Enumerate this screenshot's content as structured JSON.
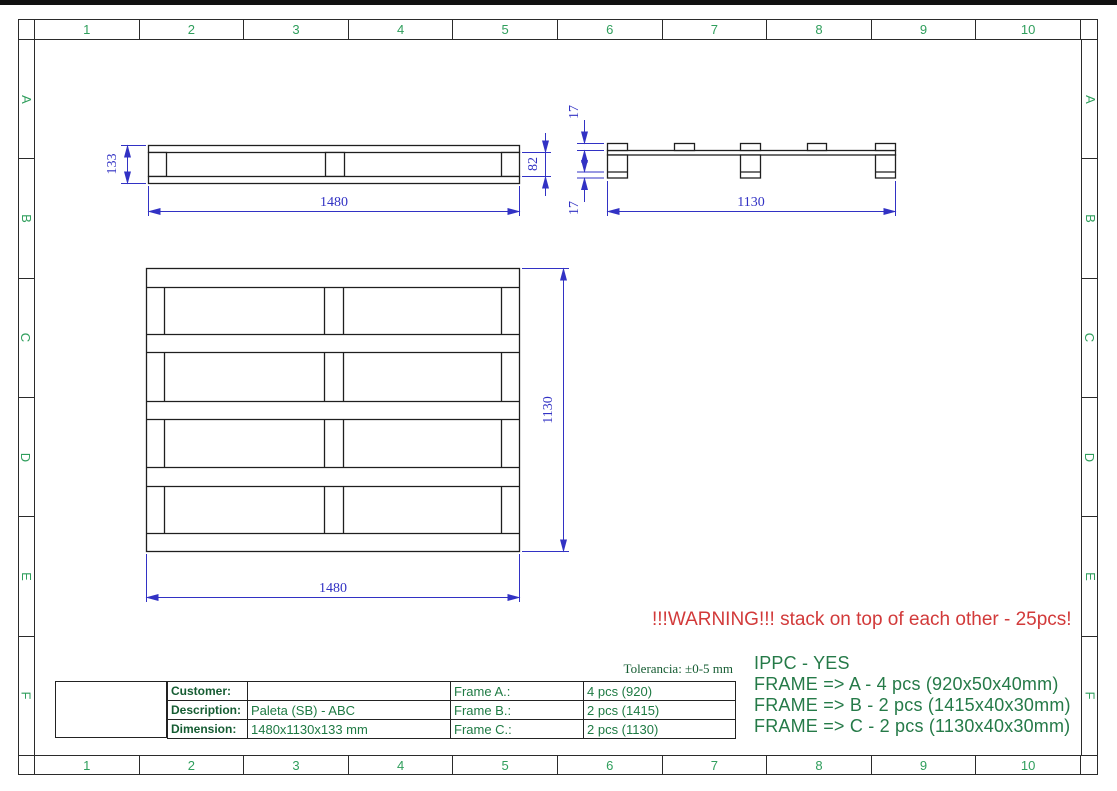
{
  "drawing": {
    "grid_columns": [
      "1",
      "2",
      "3",
      "4",
      "5",
      "6",
      "7",
      "8",
      "9",
      "10"
    ],
    "grid_rows": [
      "A",
      "B",
      "C",
      "D",
      "E",
      "F"
    ],
    "views": {
      "side": {
        "length": "1480",
        "height": "133",
        "deck_gap": "82"
      },
      "end": {
        "length": "1130",
        "top_board": "17",
        "bottom_board": "17"
      },
      "plan": {
        "length": "1480",
        "width": "1130"
      }
    },
    "warning": "!!!WARNING!!! stack on top of each other - 25pcs!",
    "tolerance": "Tolerancia: ±0-5 mm",
    "notes": {
      "ippc": "IPPC - YES",
      "frame_a": "FRAME => A - 4 pcs (920x50x40mm)",
      "frame_b": "FRAME => B - 2 pcs (1415x40x30mm)",
      "frame_c": "FRAME => C - 2 pcs (1130x40x30mm)"
    },
    "title_block": {
      "customer_label": "Customer:",
      "customer_value": "",
      "description_label": "Description:",
      "description_value": "Paleta (SB) - ABC",
      "dimension_label": "Dimension:",
      "dimension_value": "1480x1130x133 mm",
      "frame_a_label": "Frame A.:",
      "frame_a_value": "4 pcs (920)",
      "frame_b_label": "Frame B.:",
      "frame_b_value": "2 pcs (1415)",
      "frame_c_label": "Frame C.:",
      "frame_c_value": "2 pcs (1130)"
    },
    "colors": {
      "dimension_blue": "#3232c4",
      "annotation_green": "#257a48",
      "grid_green": "#2f9e5c",
      "warning_red": "#d23a3a"
    }
  }
}
